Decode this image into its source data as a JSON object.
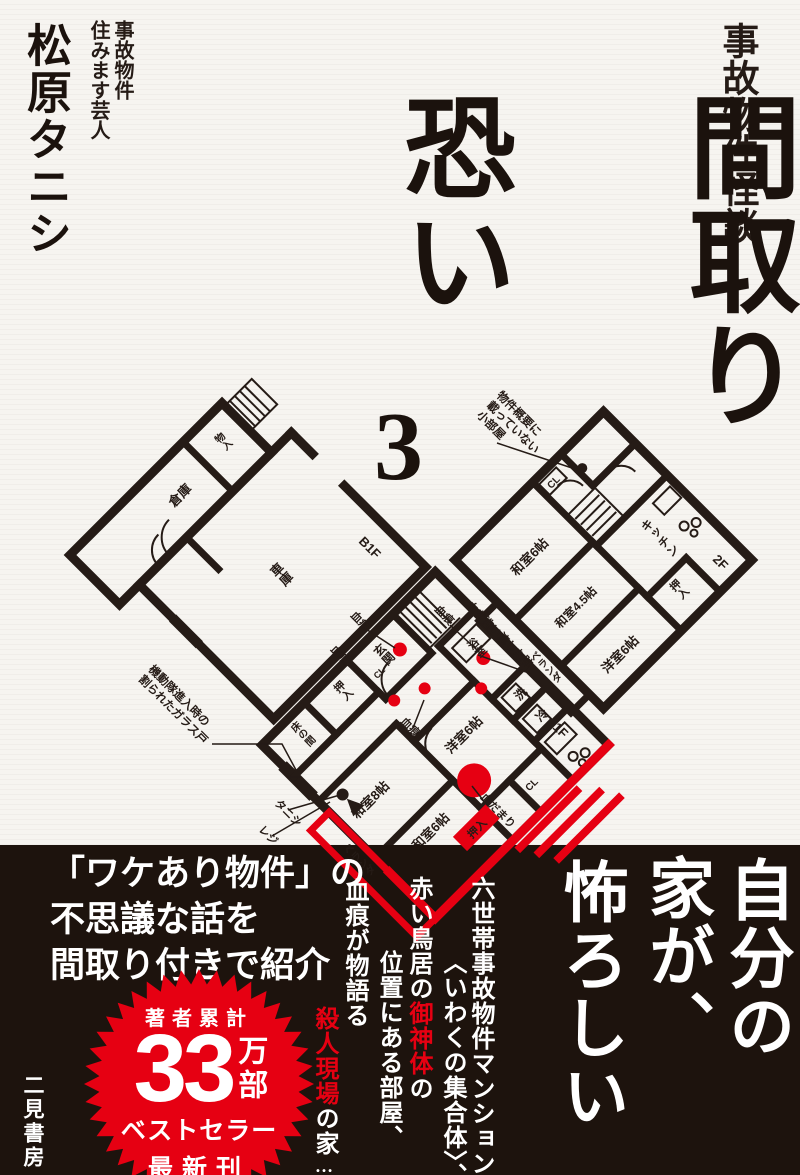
{
  "colors": {
    "red": "#e60012",
    "ink": "#251b16",
    "band_bg": "#1d130d",
    "paper": "#f6f4f0"
  },
  "header": {
    "series": "事故物件怪談",
    "author": "松原タニシ",
    "author_tag1": "事故物件",
    "author_tag2": "住みます芸人"
  },
  "title": {
    "word1": "恐い",
    "word2": "間取り",
    "volume": "3"
  },
  "plans": {
    "b1f": {
      "floor": "B1F",
      "storage": "倉庫",
      "closet": "物入",
      "garage": "車庫"
    },
    "f2": {
      "floor": "2F",
      "washitsu6": "和室6帖",
      "washitsu45": "和室4.5帖",
      "yoshitsu6": "洋室6帖",
      "kitchen": "キッチン",
      "oshiire": "押入",
      "cl": "CL",
      "veranda": "ベランダ",
      "secret1": "物件概要に",
      "secret2": "載っていない",
      "secret3": "小部屋"
    },
    "f1": {
      "floor": "1F",
      "genkan": "玄関",
      "bath": "浴室",
      "wash": "洗",
      "fridge": "冷",
      "washitsu8": "和室8帖",
      "washitsu6": "和室6帖",
      "yoshitsu6": "洋室6帖",
      "oshiire": "押入",
      "tokonoma": "床の間",
      "cl": "CL",
      "cl2": "CL",
      "oshiire_red": "押入",
      "veranda": "ベランダ",
      "blood": "血痕",
      "washed_blood": "血を洗い流した跡",
      "blood_pool": "血だまり",
      "tanishi": "タニシ",
      "reji": "レジ",
      "glass1": "機動隊進入時の",
      "glass2": "割られたガラス戸"
    }
  },
  "band": {
    "intro1": "「ワケあり物件」の",
    "intro2": "不思議な話を",
    "intro3": "間取り付きで紹介",
    "badge": {
      "top": "著者累計",
      "number": "33",
      "unit": "万部",
      "line2": "ベストセラー",
      "line3": "最新刊"
    },
    "catch1": "自分の",
    "catch2": "家が、",
    "catch3": "怖ろしい…",
    "t1": "六世帯事故物件マンション",
    "t2": "〈いわくの集合体〉、",
    "t3a": "赤い鳥居の",
    "t3b": "御神体",
    "t3c": "の",
    "t4": "位置にある部屋、",
    "t5": "血痕が物語る",
    "t6a": "殺人現場",
    "t6b": "の家",
    "t6c": "…他",
    "publisher": "二見書房"
  }
}
